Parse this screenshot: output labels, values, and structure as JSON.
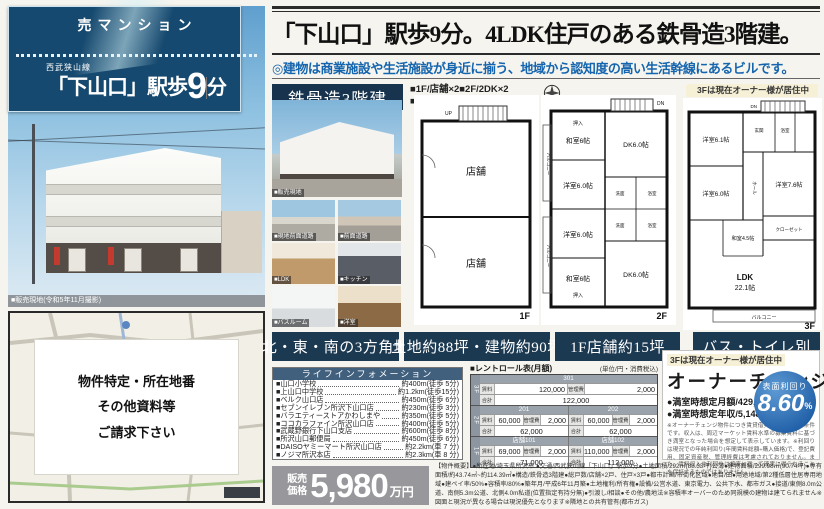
{
  "banner": {
    "tag": "売マンション",
    "rail_line": "西武狭山線",
    "station": "「下山口」駅歩",
    "minutes": "9",
    "minutes_unit": "分"
  },
  "photo_caption": "■販売現地(令和5年11月撮影)",
  "map_request": {
    "line1": "物件特定・所在地番",
    "line2": "その他資料等",
    "line3": "ご請求下さい"
  },
  "headline": "「下山口」駅歩9分。4LDK住戸のある鉄骨造3階建。",
  "subhead": "◎建物は商業施設や生活施設が身近に揃う、地域から認知度の高い生活幹線にあるビルです。",
  "structure_label": "鉄骨造3階建",
  "legend": {
    "line1": "■1F/店舗×2■2F/2DK×2",
    "line2": "■3F/4LDK×1"
  },
  "owner_tag": "3Fは現在オーナー様が居住中",
  "photos": {
    "main_caption": "■販売現地",
    "thumbs": [
      "■現地前面道路",
      "■前面道路",
      "■LDK",
      "■キッチン",
      "■バスルーム",
      "■洋室"
    ]
  },
  "plans": {
    "f1": {
      "label": "1F",
      "shop1": "店舗",
      "shop2": "店舗",
      "up": "UP"
    },
    "f2": {
      "label": "2F",
      "dn": "DN",
      "wa_top": "和室6帖",
      "yo_top": "洋室6.0帖",
      "yo_bottom": "洋室6.0帖",
      "wa_bottom": "和室6帖",
      "dk_top": "DK6.0帖",
      "dk_bottom": "DK6.0帖",
      "wash1": "洗面",
      "bath1": "浴室",
      "wash2": "洗面",
      "bath2": "浴室",
      "oshiire1": "押入",
      "oshiire2": "押入",
      "balcony1": "バルコニー",
      "balcony2": "バルコニー"
    },
    "f3": {
      "label": "3F",
      "dn": "DN",
      "r1": "洋室6.1帖",
      "genkan": "玄関",
      "bath": "浴室",
      "r2": "洋室6.0帖",
      "hall": "ホール",
      "r3": "洋室7.6帖",
      "closet": "クローゼット",
      "wa": "和室4.5帖",
      "ldk1": "LDK",
      "ldk2": "22.1帖",
      "balcony": "バルコニー"
    }
  },
  "features": [
    "北・東・南の3方角地",
    "土地約88坪・建物約90坪",
    "1F店舗約15坪",
    "バス・トイレ別"
  ],
  "life": {
    "title": "ライフインフォメーション",
    "items": [
      {
        "name": "■山口小学校",
        "value": "約400m(徒歩 5分)"
      },
      {
        "name": "■上山口中学校",
        "value": "約1.2km(徒歩15分)"
      },
      {
        "name": "■ベルク山口店",
        "value": "約450m(徒歩 6分)"
      },
      {
        "name": "■セブンイレブン所沢下山口店",
        "value": "約230m(徒歩 3分)"
      },
      {
        "name": "■バラエティーストアかわしまや",
        "value": "約350m(徒歩 5分)"
      },
      {
        "name": "■ココカラファイン所沢山口店",
        "value": "約400m(徒歩 5分)"
      },
      {
        "name": "■武蔵野銀行下山口支店",
        "value": "約600m(徒歩 8分)"
      },
      {
        "name": "■所沢山口郵便局",
        "value": "約450m(徒歩 6分)"
      },
      {
        "name": "■DAISOヤミーマート所沢山口店",
        "value": "約2.2km(車 7 分)"
      },
      {
        "name": "■ノジマ所沢本店",
        "value": "約2.3km(車 8 分)"
      }
    ]
  },
  "rent": {
    "title": "■レントロール表(月額)",
    "note": "(単位/円・消費税込)",
    "labels": {
      "rent": "賃料",
      "fee": "管理費",
      "total": "合計"
    },
    "f3": {
      "floor": "3F",
      "unit": "301",
      "rent": "120,000",
      "fee": "2,000",
      "total": "122,000"
    },
    "f2": {
      "floor": "2F",
      "a": {
        "unit": "201",
        "rent": "60,000",
        "fee": "2,000",
        "total": "62,000"
      },
      "b": {
        "unit": "202",
        "rent": "60,000",
        "fee": "2,000",
        "total": "62,000"
      }
    },
    "f1": {
      "floor": "1F",
      "a": {
        "unit": "店舗101",
        "rent": "69,000",
        "fee": "2,000",
        "total": "71,000"
      },
      "b": {
        "unit": "店舗102",
        "rent": "110,000",
        "fee": "2,000",
        "total": "112,000"
      }
    }
  },
  "owner": {
    "title": "オーナーチェンジ",
    "monthly": "●満室時想定月額/429,000円",
    "yearly": "●満室時想定年収/5,148,000円",
    "yield_label": "表面利回り",
    "yield_value": "8.60",
    "yield_unit": "%",
    "note": "※オーナーチェンジ物件につき賃貸借契約の引継ぎが条件です。収入は、周辺マーケット賃料水準の募集賃料に基づき満室となった場合を想定して表示しています。※利回りは現況での年純利回り(年間賃料総額÷購入価格)で、登記費用、固定資産税、管理経費は考慮されておりません。また、賃料収入や利回りは将来に亘って確実に得られることを保証するものではありません。"
  },
  "price": {
    "prefix1": "販売",
    "prefix2": "価格",
    "value": "5,980",
    "unit": "万円"
  },
  "overview": "【物件概要】●所在地/埼玉県所沢市 ●交通/西武狭山線「下山口」駅歩9分●土地面積/292㎡(88.33坪)公簿●建物面積/299.98㎡(90.74坪)●専有面積/約43.74㎡~約114.39㎡●構造/鉄骨造3階建●総戸数/店舗×2戸、住戸×3戸●都市計画/市街化区域●地目/田●用途地域/第2種低層住居専用地域●建ペイ率/50%●容積率/80%●築年月/平成6年11月築●土地権利/所有権●設備/公営水道、東京電力、公共下水、都市ガス●接道/東側8.0m公道、南側5.3m公道、北側4.0m私道(位置指定有持分無)●引渡し/相談●その他/農地法※容積率オーバーのため同規模の建物は建てられません※図面と現況が異なる場合は現況優先となります※隣地との共有管有(都市ガス)",
  "colors": {
    "navy": "#1c3952",
    "banner_blue": "#16496f",
    "subhead_blue": "#1565ae",
    "yield_blue": "#2261a8",
    "price_gray": "#98979b"
  }
}
